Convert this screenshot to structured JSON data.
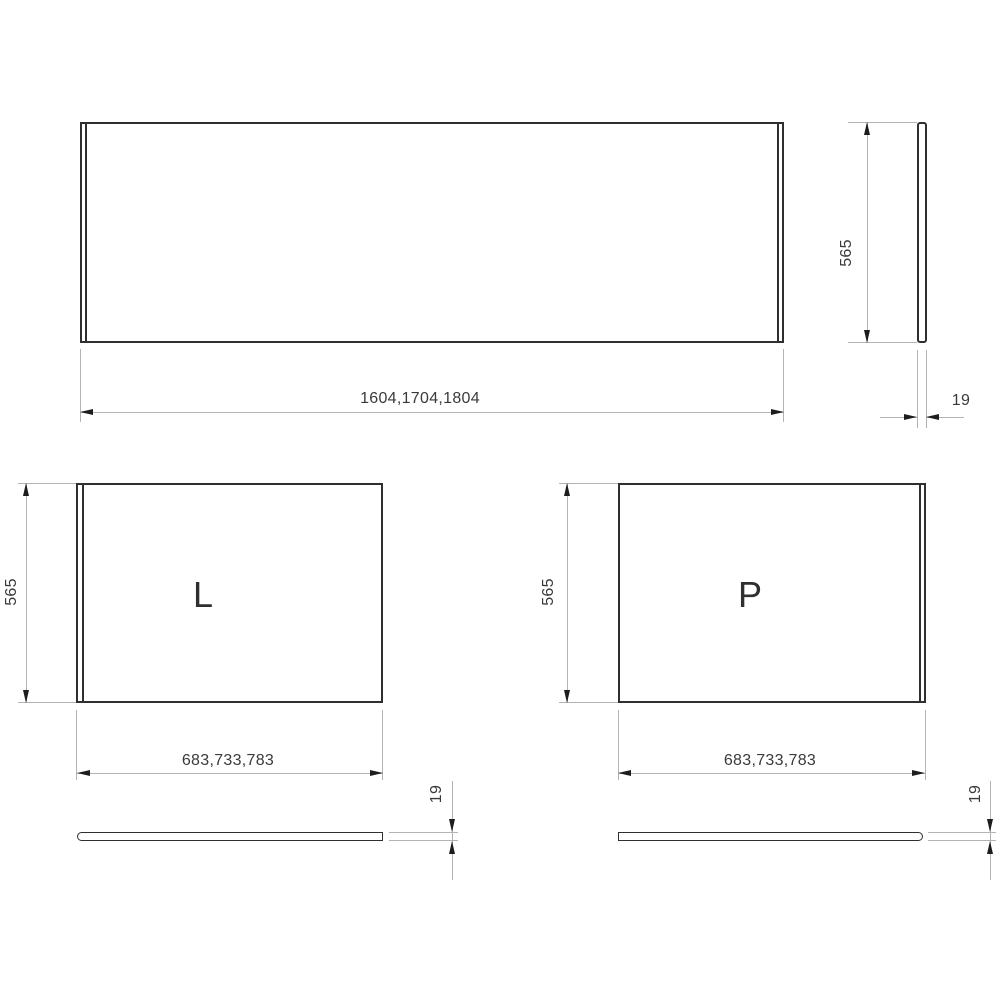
{
  "views": {
    "front": {
      "width_dim": "1604,1704,1804"
    },
    "side": {
      "height_dim": "565",
      "thickness_dim": "19"
    },
    "panel_l": {
      "label": "L",
      "height_dim": "565",
      "width_dim": "683,733,783"
    },
    "panel_l_top": {
      "thickness_dim": "19"
    },
    "panel_p": {
      "label": "P",
      "height_dim": "565",
      "width_dim": "683,733,783"
    },
    "panel_p_top": {
      "thickness_dim": "19"
    }
  },
  "colors": {
    "background": "#ffffff",
    "outline": "#2f2f2f",
    "dimension_line": "#b3b3b3",
    "arrow": "#1d1d1d",
    "text": "#3a3a3a"
  }
}
